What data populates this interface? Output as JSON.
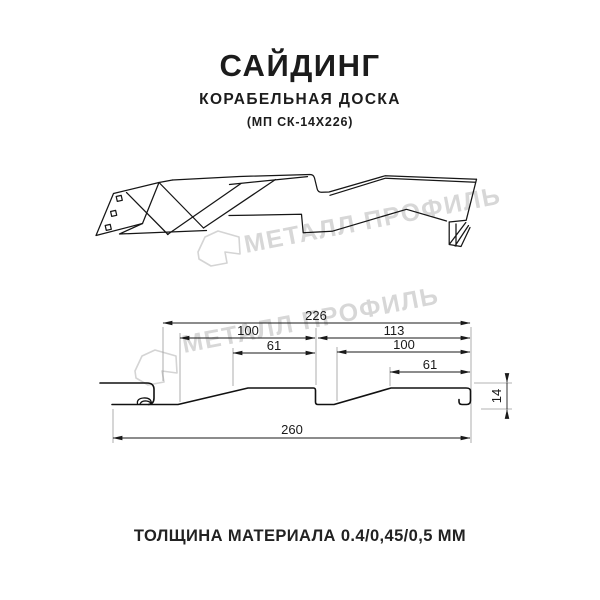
{
  "title": {
    "main": "САЙДИНГ",
    "subtitle": "КОРАБЕЛЬНАЯ ДОСКА",
    "model": "(МП СК-14Х226)"
  },
  "watermark": {
    "text": "МЕТАЛЛ ПРОФИЛЬ",
    "color": "#d7d7d7"
  },
  "section_drawing": {
    "dimensions": {
      "overall_top": "226",
      "left_flat": "100",
      "left_top_face": "61",
      "right_segment": "113",
      "right_flat": "100",
      "right_top_face": "61",
      "overall_bottom": "260",
      "profile_height": "14"
    }
  },
  "footer": {
    "text": "ТОЛЩИНА МАТЕРИАЛА 0.4/0,45/0,5 ММ"
  },
  "colors": {
    "line": "#1a1a1a",
    "extension": "#9a9a9a",
    "background": "#ffffff"
  }
}
